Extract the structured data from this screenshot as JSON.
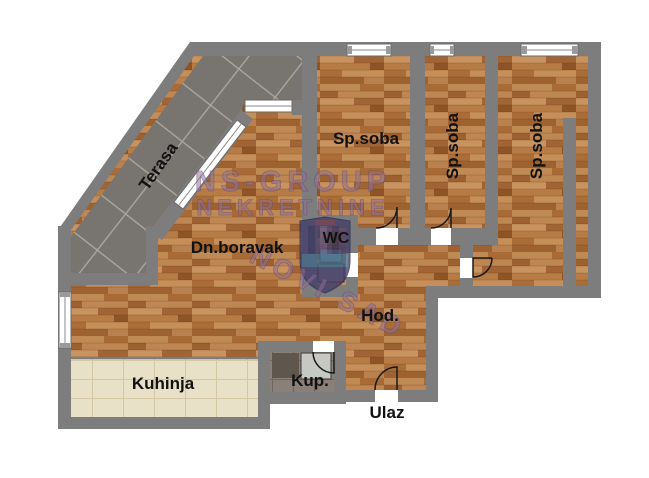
{
  "floorplan": {
    "rooms": {
      "terrace": {
        "label": "Terasa"
      },
      "bedroom1": {
        "label": "Sp.soba"
      },
      "bedroom2": {
        "label": "Sp.soba"
      },
      "bedroom3": {
        "label": "Sp.soba"
      },
      "living": {
        "label": "Dn.boravak"
      },
      "wc": {
        "label": "WC"
      },
      "hallway": {
        "label": "Hod."
      },
      "kitchen": {
        "label": "Kuhinja"
      },
      "bathroom": {
        "label": "Kup."
      },
      "entrance": {
        "label": "Ulaz"
      }
    },
    "watermark": {
      "brand_line1": "NS-GROUP",
      "brand_line2": "NEKRETNINE",
      "brand_line3": "NOVI SAD"
    }
  },
  "colors": {
    "wall": "#7d7d7d",
    "wood_base": "#b67c4a",
    "terrace_tile": "#787470",
    "terrace_grout": "#a9a5a0",
    "kitchen_tile": "#e9e0c8",
    "kitchen_grout": "#d2c6a6",
    "bath_tile": "#8a8078",
    "bath_grout": "#6f665e",
    "window_fill": "#ffffff",
    "door_stroke": "#1a1a1a",
    "label_text": "#111111",
    "watermark_fill": "#8f6f96",
    "watermark_outline": "#5a4470",
    "shield_fill": "#433e6b"
  }
}
